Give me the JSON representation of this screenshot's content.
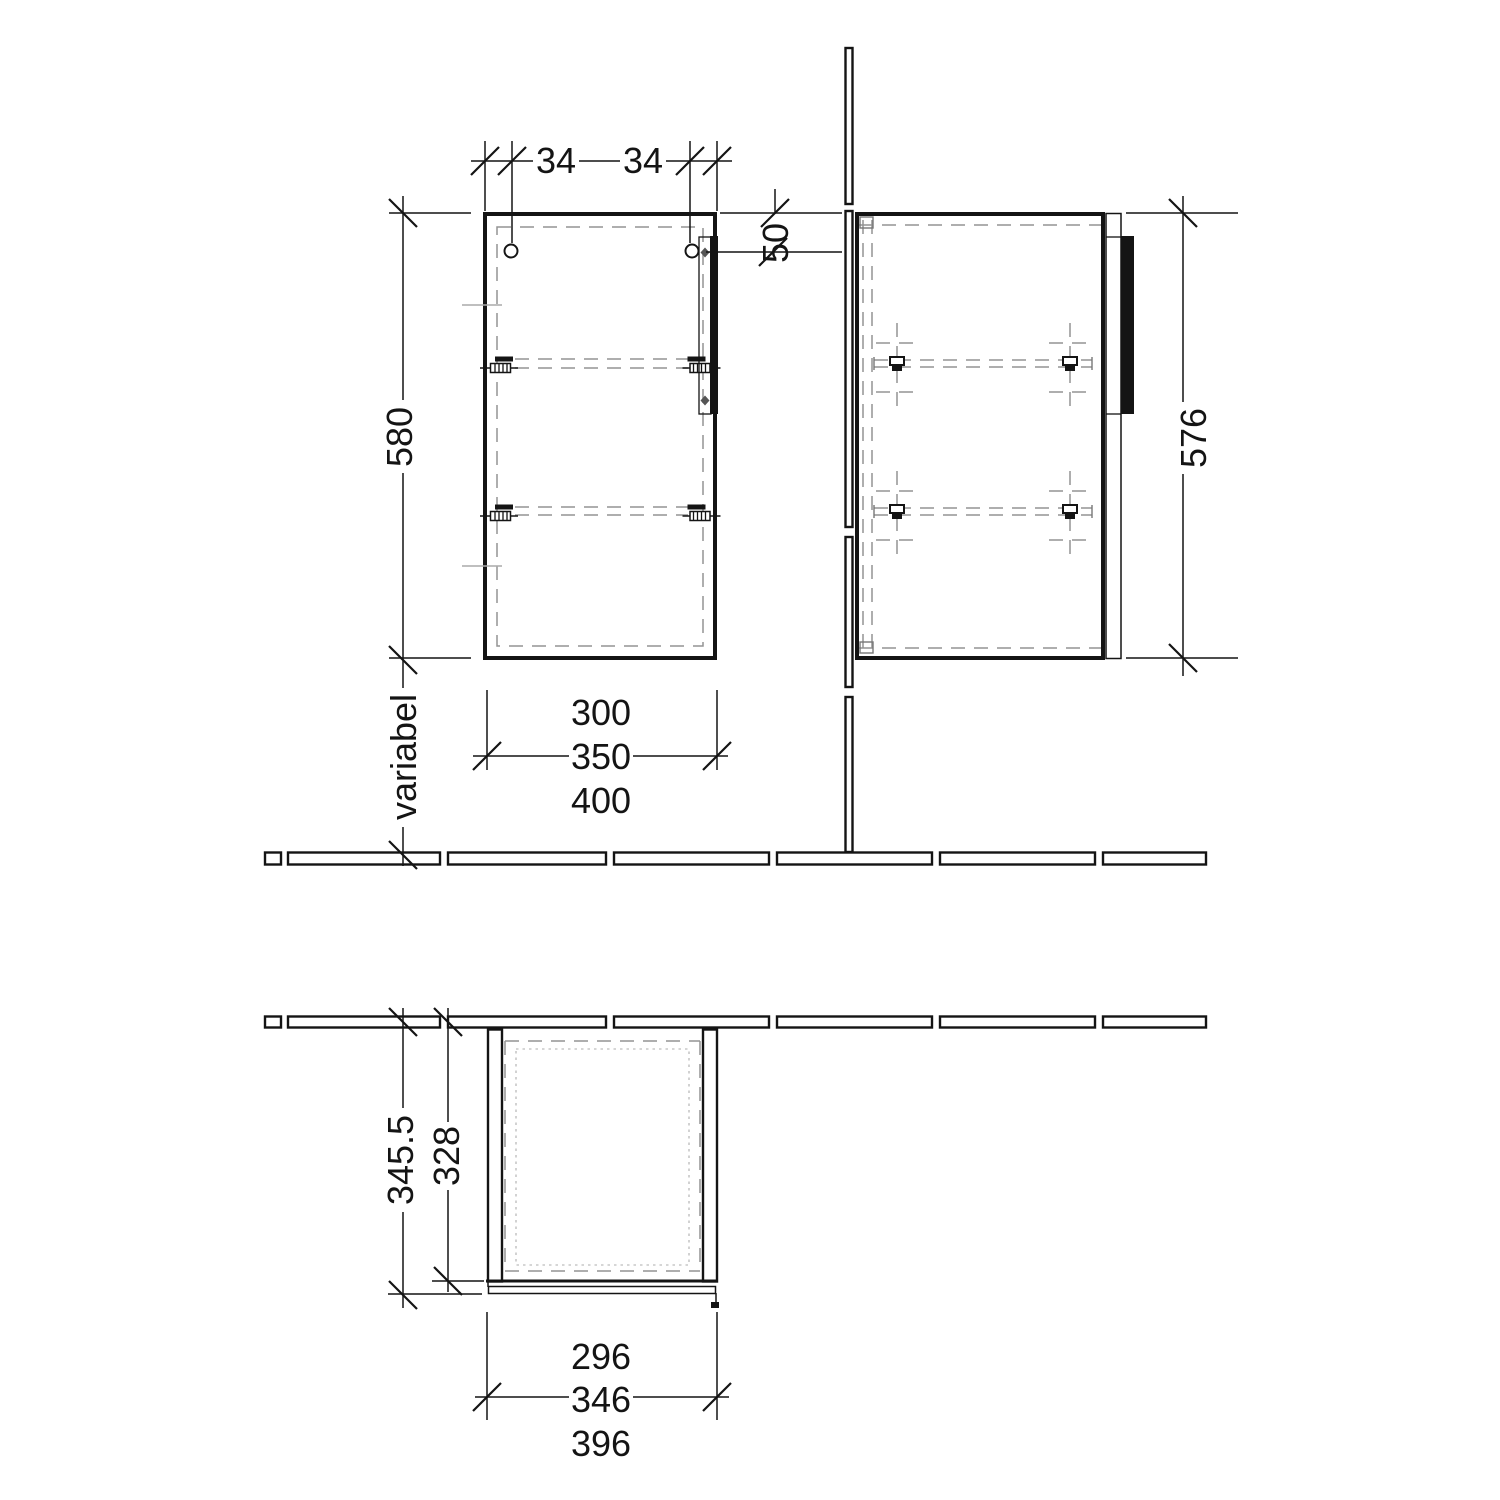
{
  "drawing": {
    "title": "wall cabinet installation drawing, three orthographic views",
    "colors": {
      "line": "#141414",
      "dashed_gray": "#949494",
      "handle_fill": "#111111",
      "background": "#ffffff"
    },
    "front_view": {
      "name": "front view",
      "dims": {
        "hole_offset_left": "34",
        "hole_offset_right": "34",
        "handle_top_offset": "50",
        "height": "580",
        "floor_distance": "variabel",
        "width_variant_1": "300",
        "width_variant_2": "350",
        "width_variant_3": "400"
      }
    },
    "side_view": {
      "name": "side view",
      "dims": {
        "height": "576"
      }
    },
    "top_view": {
      "name": "plan view",
      "dims": {
        "depth_overall": "345.5",
        "depth_carcass": "328",
        "door_width_variant_1": "296",
        "door_width_variant_2": "346",
        "door_width_variant_3": "396"
      }
    }
  }
}
